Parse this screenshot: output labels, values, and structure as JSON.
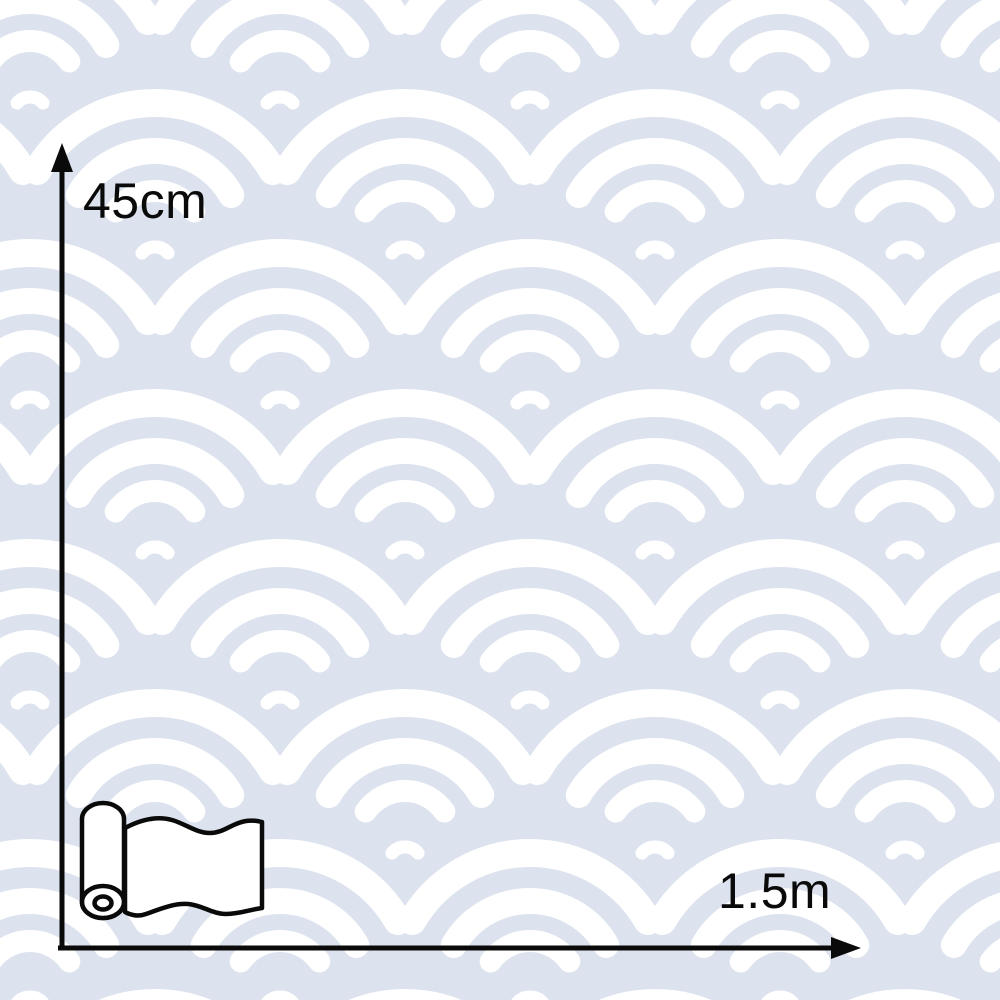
{
  "pattern": {
    "style": "seigaiha-scallop-wave",
    "background_color": "#dce3ee",
    "wave_color": "#ffffff"
  },
  "annotations": {
    "ink_color": "#0a0a0a",
    "height": {
      "label": "45cm",
      "direction": "up"
    },
    "width": {
      "label": "1.5m",
      "direction": "right"
    }
  },
  "icons": {
    "roll": "wallpaper-roll-icon"
  }
}
